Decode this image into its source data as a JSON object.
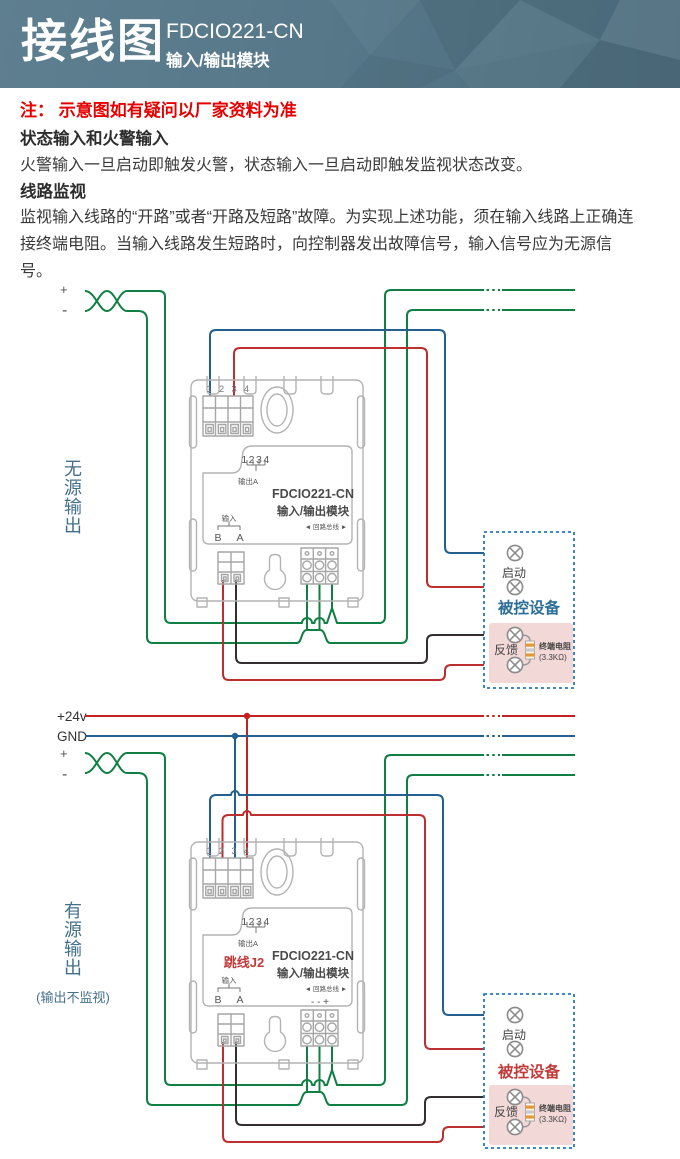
{
  "header": {
    "title": "接线图",
    "model": "FDCIO221-CN",
    "subtitle": "输入/输出模块"
  },
  "note": "注： 示意图如有疑问以厂家资料为准",
  "sections": [
    {
      "heading": "状态输入和火警输入",
      "body": "火警输入一旦启动即触发火警，状态输入一旦启动即触发监视状态改变。"
    },
    {
      "heading": "线路监视",
      "body": "监视输入线路的“开路”或者“开路及短路”故障。为实现上述功能，须在输入线路上正确连接终端电阻。当输入线路发生短路时，向控制器发出故障信号，输入信号应为无源信号。"
    }
  ],
  "module": {
    "terminals": [
      "1",
      "2",
      "3",
      "4"
    ],
    "digits": "1234",
    "output_a": "输出A",
    "model": "FDCIO221-CN",
    "name": "输入/输出模块",
    "input": "输入",
    "b": "B",
    "a": "A",
    "loop_bus": "◄ 回路总线 ►"
  },
  "diagram1": {
    "side_label": "无\n源\n输\n出",
    "plus": "+",
    "minus": "-",
    "device_box": "被控设备",
    "start": "启动",
    "feedback": "反馈",
    "resistor_name": "终端电阻",
    "resistor_value": "(3.3KΩ)"
  },
  "diagram2": {
    "side_label": "有\n源\n输\n出",
    "side_note": "(输出不监视)",
    "v24": "+24v",
    "gnd": "GND",
    "plus": "+",
    "minus": "-",
    "jumper": "跳线J2",
    "polarity": "-   -   +",
    "device_box": "被控设备",
    "start": "启动",
    "feedback": "反馈",
    "resistor_name": "终端电阻",
    "resistor_value": "(3.3KΩ)"
  },
  "colors": {
    "header_bg": "#56788a",
    "note_red": "#e60000",
    "wire_green": "#0f7f44",
    "wire_blue": "#23608f",
    "wire_red": "#bd2e2e",
    "wire_black": "#332f2f",
    "bus_red": "#c32222",
    "device_box_border": "#2879b9",
    "device1_label": "#2b6e96",
    "device2_label": "#c23b3b",
    "feedback_panel": "#f3d8d8",
    "jumper_label": "#c23b3b",
    "side_label": "#44708a",
    "module_outline": "#b3b3b3"
  }
}
